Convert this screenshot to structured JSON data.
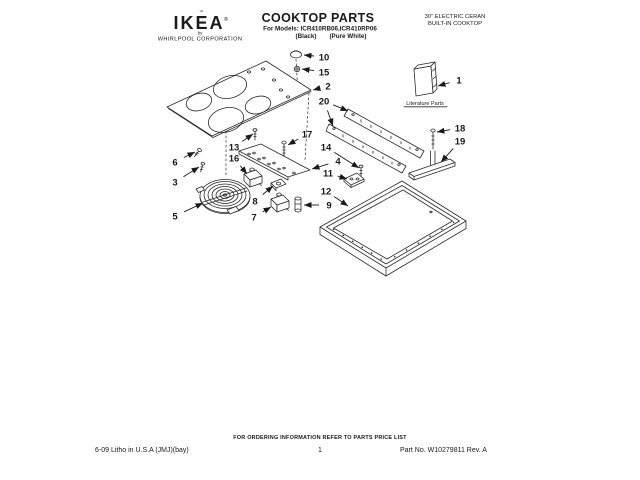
{
  "colors": {
    "ink": "#1a1a1a",
    "paper": "#ffffff"
  },
  "brand": {
    "tm_mark": "™",
    "logo_text": "IKEA",
    "reg_mark": "®",
    "byline_by": "by",
    "byline_company": "WHIRLPOOL CORPORATION"
  },
  "header": {
    "title": "COOKTOP PARTS",
    "models_line": "For Models: ICR410RB06,ICR410RP06",
    "color_left": "(Black)",
    "color_right": "(Pure White)",
    "product_line1": "30\" ELECTRIC CERAN",
    "product_line2": "BUILT-IN COOKTOP"
  },
  "diagram": {
    "literature_label": "Literature Parts",
    "callouts": [
      {
        "n": "1",
        "x": 459,
        "y": 80,
        "tx": 438,
        "ty": 86
      },
      {
        "n": "2",
        "x": 328,
        "y": 86,
        "tx": 313,
        "ty": 90
      },
      {
        "n": "3",
        "x": 175,
        "y": 182,
        "tx": 199,
        "ty": 167
      },
      {
        "n": "4",
        "x": 338,
        "y": 161,
        "tx": 312,
        "ty": 169
      },
      {
        "n": "5",
        "x": 175,
        "y": 216,
        "tx": 203,
        "ty": 203
      },
      {
        "n": "6",
        "x": 175,
        "y": 162,
        "tx": 195,
        "ty": 152
      },
      {
        "n": "7",
        "x": 254,
        "y": 217,
        "tx": 271,
        "ty": 207
      },
      {
        "n": "8",
        "x": 255,
        "y": 201,
        "tx": 273,
        "ty": 186
      },
      {
        "n": "9",
        "x": 329,
        "y": 205,
        "tx": 304,
        "ty": 205
      },
      {
        "n": "10",
        "x": 324,
        "y": 57,
        "tx": 304,
        "ty": 55
      },
      {
        "n": "11",
        "x": 328,
        "y": 173,
        "tx": 347,
        "ty": 179
      },
      {
        "n": "12",
        "x": 326,
        "y": 191,
        "tx": 348,
        "ty": 206
      },
      {
        "n": "13",
        "x": 234,
        "y": 147,
        "tx": 253,
        "ty": 134
      },
      {
        "n": "14",
        "x": 326,
        "y": 147,
        "tx": 359,
        "ty": 168
      },
      {
        "n": "15",
        "x": 324,
        "y": 72,
        "tx": 302,
        "ty": 69
      },
      {
        "n": "16",
        "x": 234,
        "y": 158,
        "tx": 247,
        "ty": 174
      },
      {
        "n": "17",
        "x": 307,
        "y": 134,
        "tx": 288,
        "ty": 145
      },
      {
        "n": "18",
        "x": 460,
        "y": 128,
        "tx": 437,
        "ty": 132
      },
      {
        "n": "19",
        "x": 460,
        "y": 141,
        "tx": 441,
        "ty": 162
      },
      {
        "n": "20",
        "x": 324,
        "y": 101,
        "tx": 348,
        "ty": 111,
        "tx2": 333,
        "ty2": 126
      }
    ]
  },
  "footer": {
    "ordering_note": "FOR ORDERING INFORMATION REFER TO PARTS PRICE LIST",
    "litho": "6-09 Litho in U.S.A (JMJ)(bay)",
    "page_number": "1",
    "part_no": "Part No. W10279811 Rev. A"
  }
}
